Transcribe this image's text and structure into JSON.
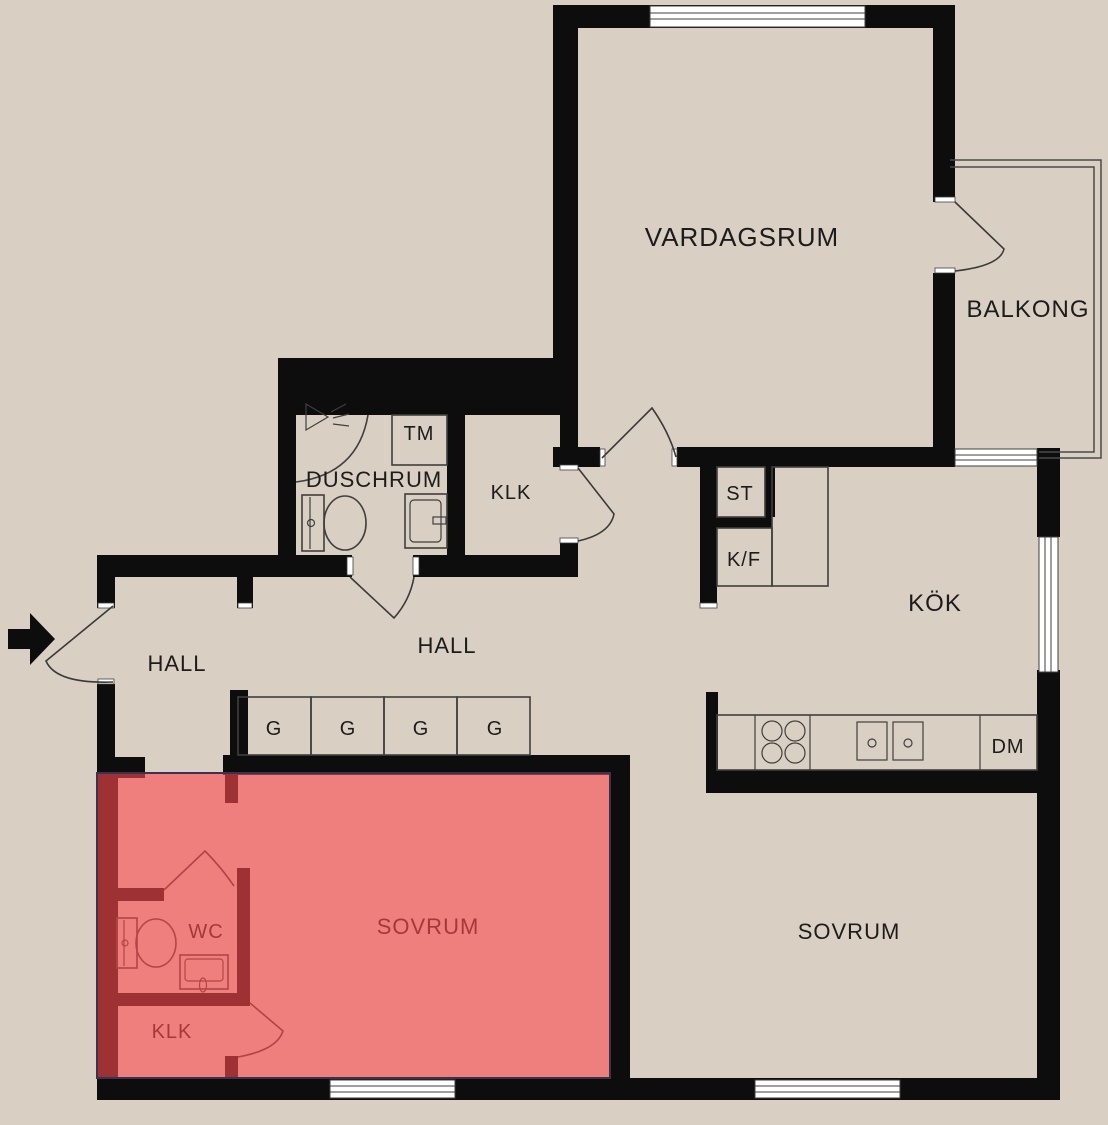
{
  "title": "Apartment floor plan with highlighted bedroom suite",
  "colors": {
    "background": "#d9d0c3",
    "wall": "#0d0d0d",
    "fixture_outline": "#3f3f3f",
    "window": "#ffffff",
    "highlight_overlay": "rgba(254,73,77,0.6)",
    "highlight_border": "#3b3252",
    "highlight_room_fill": "#ef7f7c",
    "highlight_wall": "#9d3133",
    "text": "#1c1c1c"
  },
  "labels": {
    "vardagsrum": "VARDAGSRUM",
    "balkong": "BALKONG",
    "duschrum": "DUSCHRUM",
    "tm": "TM",
    "klk_hall": "KLK",
    "st": "ST",
    "kf": "K/F",
    "kok": "KÖK",
    "hall_entry": "HALL",
    "hall_corridor": "HALL",
    "g": "G",
    "dm": "DM",
    "sovrum_highlighted": "SOVRUM",
    "sovrum_right": "SOVRUM",
    "wc": "WC",
    "klk_bedroom": "KLK"
  }
}
